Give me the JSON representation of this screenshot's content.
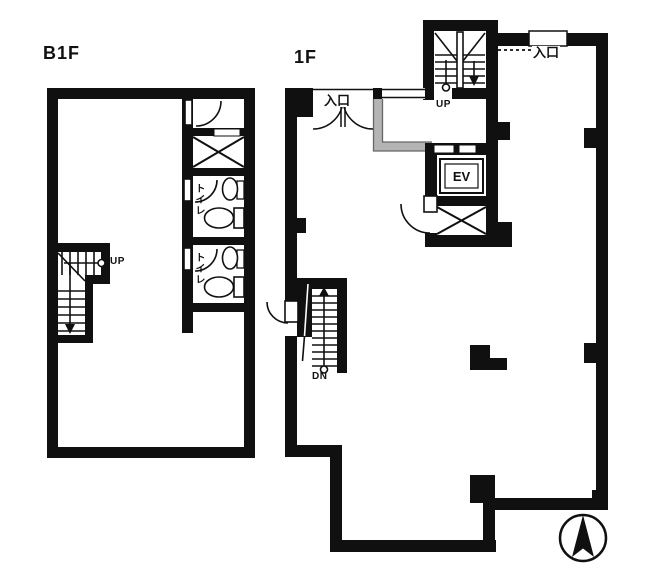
{
  "drawing": {
    "type": "building floor plan",
    "background": "#ffffff",
    "wall_color": "#111111",
    "entry_step_gray": "#b4b4b4"
  },
  "b1f": {
    "floor_label": "B1F",
    "stair_up_label": "UP",
    "toilet_1_label": "トイレ",
    "toilet_2_label": "トイレ"
  },
  "f1": {
    "floor_label": "1F",
    "stair_up_label": "UP",
    "stair_down_label": "DN",
    "side_entrance_label": "入口",
    "main_entrance_label": "入口",
    "elevator_label": "EV"
  },
  "icons": {
    "compass": "north-arrow"
  }
}
